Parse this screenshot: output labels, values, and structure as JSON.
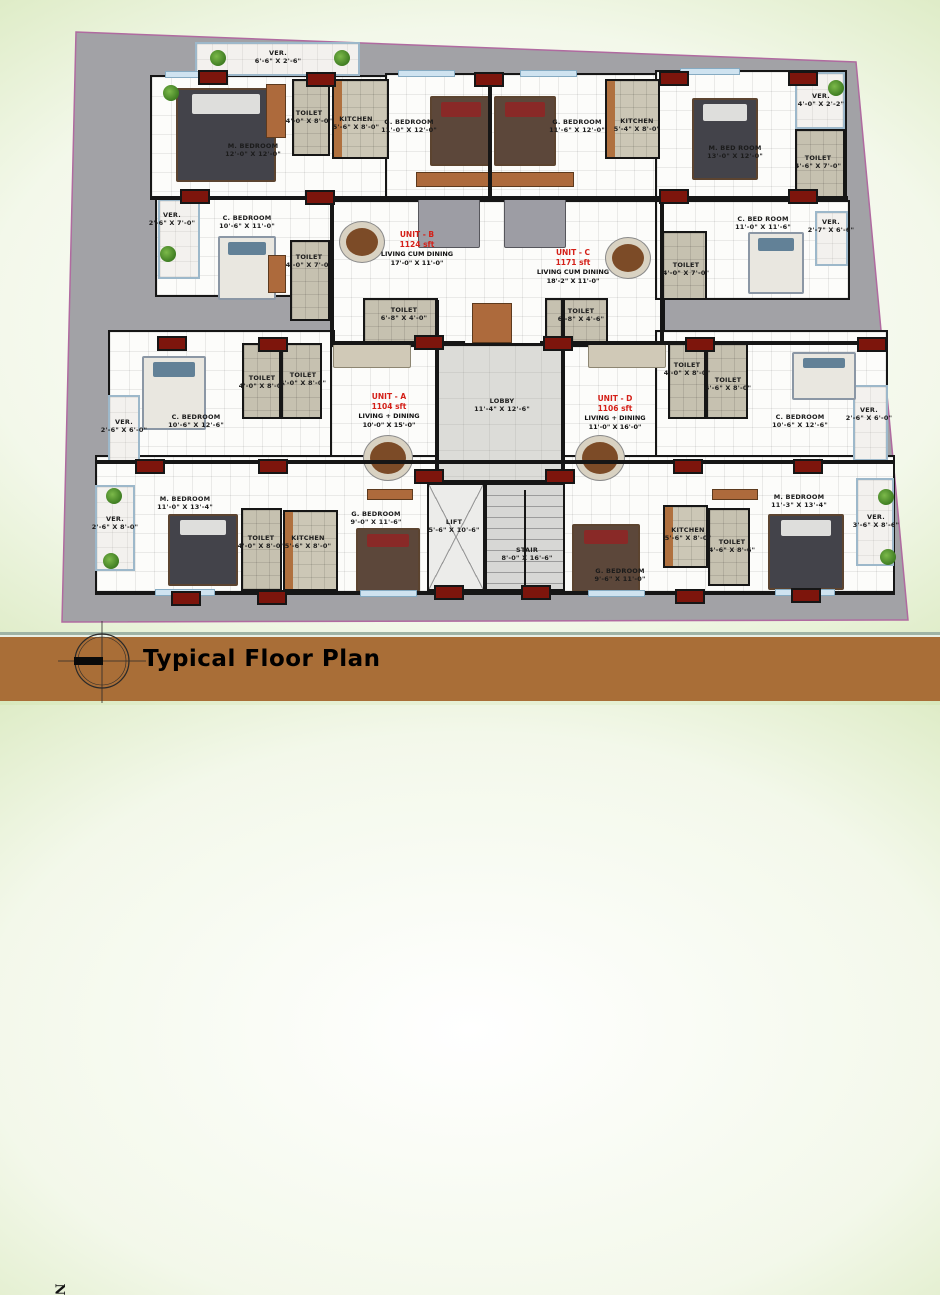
{
  "title": "Typical Floor Plan",
  "compass": {
    "north_label": "N"
  },
  "colors": {
    "background_green": "#8abc55",
    "plot_gray": "#a2a2a6",
    "plot_edge": "#b06aa0",
    "wall_black": "#161616",
    "column_red": "#7d150c",
    "unit_label_red": "#d42018",
    "title_bar_brown": "#a96e37",
    "veranda_rail_blue": "#9db8ca"
  },
  "plan": {
    "units": [
      {
        "name": "UNIT - A",
        "area": "1104 sft",
        "living": "LIVING + DINING",
        "living_dim": "10'-0\" X 15'-0\"",
        "x": 389,
        "y": 411
      },
      {
        "name": "UNIT - B",
        "area": "1124 sft",
        "living": "LIVING CUM DINING",
        "living_dim": "17'-0\" X 11'-0\"",
        "x": 417,
        "y": 249
      },
      {
        "name": "UNIT - C",
        "area": "1171 sft",
        "living": "LIVING CUM DINING",
        "living_dim": "18'-2\" X 11'-0\"",
        "x": 573,
        "y": 267
      },
      {
        "name": "UNIT - D",
        "area": "1106 sft",
        "living": "LIVING + DINING",
        "living_dim": "11'-0\" X 16'-0\"",
        "x": 615,
        "y": 413
      }
    ],
    "rooms": [
      {
        "label": "VER.",
        "dim": "6'-6\" X 2'-6\"",
        "x": 278,
        "y": 57
      },
      {
        "label": "M. BEDROOM",
        "dim": "12'-0\" X 12'-0\"",
        "x": 253,
        "y": 150
      },
      {
        "label": "TOILET",
        "dim": "4'-0\" X 8'-0\"",
        "x": 309,
        "y": 117
      },
      {
        "label": "KITCHEN",
        "dim": "5'-6\" X 8'-0\"",
        "x": 356,
        "y": 123
      },
      {
        "label": "G. BEDROOM",
        "dim": "11'-0\" X 12'-0\"",
        "x": 409,
        "y": 126
      },
      {
        "label": "G. BEDROOM",
        "dim": "11'-6\" X 12'-0\"",
        "x": 577,
        "y": 126
      },
      {
        "label": "KITCHEN",
        "dim": "5'-4\" X 8'-0\"",
        "x": 637,
        "y": 125
      },
      {
        "label": "M. BED ROOM",
        "dim": "13'-0\" X 12'-0\"",
        "x": 735,
        "y": 152
      },
      {
        "label": "VER.",
        "dim": "4'-0\" X 2'-2\"",
        "x": 821,
        "y": 100
      },
      {
        "label": "TOILET",
        "dim": "4'-6\" X 7'-0\"",
        "x": 818,
        "y": 162
      },
      {
        "label": "VER.",
        "dim": "2'-6\" X 7'-0\"",
        "x": 172,
        "y": 219
      },
      {
        "label": "C. BEDROOM",
        "dim": "10'-6\" X 11'-0\"",
        "x": 247,
        "y": 222
      },
      {
        "label": "TOILET",
        "dim": "4'-0\" X 7'-0\"",
        "x": 309,
        "y": 261
      },
      {
        "label": "C. BED ROOM",
        "dim": "11'-0\" X 11'-6\"",
        "x": 763,
        "y": 223
      },
      {
        "label": "TOILET",
        "dim": "4'-0\" X 7'-0\"",
        "x": 686,
        "y": 269
      },
      {
        "label": "VER.",
        "dim": "2'-7\" X 6'-6\"",
        "x": 831,
        "y": 226
      },
      {
        "label": "TOILET",
        "dim": "6'-8\" X 4'-0\"",
        "x": 404,
        "y": 314
      },
      {
        "label": "TOILET",
        "dim": "6'-8\" X 4'-6\"",
        "x": 581,
        "y": 315
      },
      {
        "label": "LOBBY",
        "dim": "11'-4\" X 12'-6\"",
        "x": 502,
        "y": 405
      },
      {
        "label": "C. BEDROOM",
        "dim": "10'-6\" X 12'-6\"",
        "x": 196,
        "y": 421
      },
      {
        "label": "VER.",
        "dim": "2'-6\" X 6'-0\"",
        "x": 124,
        "y": 426
      },
      {
        "label": "TOILET",
        "dim": "4'-0\" X 8'-0\"",
        "x": 262,
        "y": 382
      },
      {
        "label": "TOILET",
        "dim": "4'-0\" X 8'-0\"",
        "x": 303,
        "y": 379
      },
      {
        "label": "TOILET",
        "dim": "4'-0\" X 8'-0\"",
        "x": 687,
        "y": 369
      },
      {
        "label": "TOILET",
        "dim": "4'-6\" X 8'-0\"",
        "x": 728,
        "y": 384
      },
      {
        "label": "C. BEDROOM",
        "dim": "10'-6\" X 12'-6\"",
        "x": 800,
        "y": 421
      },
      {
        "label": "VER.",
        "dim": "2'-6\" X 6'-0\"",
        "x": 869,
        "y": 414
      },
      {
        "label": "M. BEDROOM",
        "dim": "11'-0\" X 13'-4\"",
        "x": 185,
        "y": 503
      },
      {
        "label": "VER.",
        "dim": "2'-6\" X 8'-0\"",
        "x": 115,
        "y": 523
      },
      {
        "label": "TOILET",
        "dim": "4'-0\" X 8'-0\"",
        "x": 261,
        "y": 542
      },
      {
        "label": "KITCHEN",
        "dim": "5'-6\" X 8'-0\"",
        "x": 308,
        "y": 542
      },
      {
        "label": "G. BEDROOM",
        "dim": "9'-0\" X 11'-6\"",
        "x": 376,
        "y": 518
      },
      {
        "label": "LIFT",
        "dim": "5'-6\" X 10'-6\"",
        "x": 454,
        "y": 526
      },
      {
        "label": "STAIR",
        "dim": "8'-0\" X 16'-6\"",
        "x": 527,
        "y": 554
      },
      {
        "label": "G. BEDROOM",
        "dim": "9'-6\" X 11'-0\"",
        "x": 620,
        "y": 575
      },
      {
        "label": "KITCHEN",
        "dim": "5'-6\" X 8'-0\"",
        "x": 688,
        "y": 534
      },
      {
        "label": "TOILET",
        "dim": "4'-6\" X 8'-6\"",
        "x": 732,
        "y": 546
      },
      {
        "label": "M. BEDROOM",
        "dim": "11'-3\" X 13'-4\"",
        "x": 799,
        "y": 501
      },
      {
        "label": "VER.",
        "dim": "3'-6\" X 8'-6\"",
        "x": 876,
        "y": 521
      }
    ],
    "masses": [
      {
        "x": 150,
        "y": 75,
        "w": 243,
        "h": 124
      },
      {
        "x": 385,
        "y": 73,
        "w": 278,
        "h": 132
      },
      {
        "x": 655,
        "y": 70,
        "w": 192,
        "h": 132
      },
      {
        "x": 155,
        "y": 197,
        "w": 178,
        "h": 100
      },
      {
        "x": 330,
        "y": 200,
        "w": 335,
        "h": 145
      },
      {
        "x": 655,
        "y": 200,
        "w": 195,
        "h": 100
      },
      {
        "x": 108,
        "y": 330,
        "w": 227,
        "h": 134
      },
      {
        "x": 330,
        "y": 345,
        "w": 335,
        "h": 137
      },
      {
        "x": 655,
        "y": 330,
        "w": 233,
        "h": 134
      },
      {
        "x": 95,
        "y": 455,
        "w": 800,
        "h": 140
      }
    ],
    "zones": [
      {
        "t": "ver",
        "x": 195,
        "y": 42,
        "w": 165,
        "h": 34
      },
      {
        "t": "toilet",
        "x": 292,
        "y": 79,
        "w": 38,
        "h": 77
      },
      {
        "t": "kitchen",
        "x": 332,
        "y": 79,
        "w": 57,
        "h": 80
      },
      {
        "t": "kitchen",
        "x": 605,
        "y": 79,
        "w": 55,
        "h": 80
      },
      {
        "t": "ver",
        "x": 795,
        "y": 72,
        "w": 50,
        "h": 57
      },
      {
        "t": "toilet",
        "x": 795,
        "y": 129,
        "w": 50,
        "h": 69
      },
      {
        "t": "ver",
        "x": 158,
        "y": 199,
        "w": 42,
        "h": 80
      },
      {
        "t": "toilet",
        "x": 290,
        "y": 240,
        "w": 40,
        "h": 81
      },
      {
        "t": "toilet",
        "x": 662,
        "y": 231,
        "w": 45,
        "h": 69
      },
      {
        "t": "ver",
        "x": 815,
        "y": 211,
        "w": 33,
        "h": 55
      },
      {
        "t": "toilet",
        "x": 363,
        "y": 298,
        "w": 75,
        "h": 46
      },
      {
        "t": "toilet",
        "x": 545,
        "y": 298,
        "w": 63,
        "h": 46
      },
      {
        "t": "lobby",
        "x": 437,
        "y": 346,
        "w": 126,
        "h": 136
      },
      {
        "t": "ver",
        "x": 108,
        "y": 395,
        "w": 32,
        "h": 67
      },
      {
        "t": "toilet",
        "x": 242,
        "y": 343,
        "w": 39,
        "h": 76
      },
      {
        "t": "toilet",
        "x": 281,
        "y": 343,
        "w": 41,
        "h": 76
      },
      {
        "t": "toilet",
        "x": 668,
        "y": 343,
        "w": 38,
        "h": 76
      },
      {
        "t": "toilet",
        "x": 706,
        "y": 343,
        "w": 42,
        "h": 76
      },
      {
        "t": "ver",
        "x": 853,
        "y": 385,
        "w": 35,
        "h": 76
      },
      {
        "t": "ver",
        "x": 95,
        "y": 485,
        "w": 40,
        "h": 86
      },
      {
        "t": "toilet",
        "x": 241,
        "y": 508,
        "w": 41,
        "h": 83
      },
      {
        "t": "kitchen",
        "x": 283,
        "y": 510,
        "w": 55,
        "h": 81
      },
      {
        "t": "lift",
        "x": 427,
        "y": 483,
        "w": 58,
        "h": 108
      },
      {
        "t": "stair",
        "x": 485,
        "y": 483,
        "w": 80,
        "h": 108
      },
      {
        "t": "kitchen",
        "x": 663,
        "y": 505,
        "w": 45,
        "h": 63
      },
      {
        "t": "toilet",
        "x": 708,
        "y": 508,
        "w": 42,
        "h": 78
      },
      {
        "t": "ver",
        "x": 856,
        "y": 478,
        "w": 38,
        "h": 88
      }
    ],
    "walls": [
      {
        "x": 488,
        "y": 75,
        "w": 4,
        "h": 125
      },
      {
        "x": 150,
        "y": 196,
        "w": 698,
        "h": 4
      },
      {
        "x": 330,
        "y": 341,
        "w": 135,
        "h": 4
      },
      {
        "x": 540,
        "y": 341,
        "w": 348,
        "h": 4
      },
      {
        "x": 95,
        "y": 460,
        "w": 800,
        "h": 4
      },
      {
        "x": 95,
        "y": 591,
        "w": 798,
        "h": 4
      },
      {
        "x": 435,
        "y": 300,
        "w": 4,
        "h": 184
      },
      {
        "x": 561,
        "y": 300,
        "w": 4,
        "h": 184
      },
      {
        "x": 425,
        "y": 480,
        "w": 142,
        "h": 4
      },
      {
        "x": 483,
        "y": 483,
        "w": 4,
        "h": 108
      },
      {
        "x": 524,
        "y": 490,
        "w": 2,
        "h": 95
      },
      {
        "x": 330,
        "y": 200,
        "w": 4,
        "h": 145
      },
      {
        "x": 660,
        "y": 200,
        "w": 4,
        "h": 145
      }
    ],
    "columns": [
      {
        "x": 213,
        "y": 77
      },
      {
        "x": 321,
        "y": 79
      },
      {
        "x": 489,
        "y": 79
      },
      {
        "x": 674,
        "y": 78
      },
      {
        "x": 803,
        "y": 78
      },
      {
        "x": 195,
        "y": 196
      },
      {
        "x": 320,
        "y": 197
      },
      {
        "x": 674,
        "y": 196
      },
      {
        "x": 803,
        "y": 196
      },
      {
        "x": 172,
        "y": 343
      },
      {
        "x": 273,
        "y": 344
      },
      {
        "x": 429,
        "y": 342
      },
      {
        "x": 558,
        "y": 343
      },
      {
        "x": 700,
        "y": 344
      },
      {
        "x": 872,
        "y": 344
      },
      {
        "x": 150,
        "y": 466
      },
      {
        "x": 273,
        "y": 466
      },
      {
        "x": 429,
        "y": 476
      },
      {
        "x": 560,
        "y": 476
      },
      {
        "x": 688,
        "y": 466
      },
      {
        "x": 808,
        "y": 466
      },
      {
        "x": 186,
        "y": 598
      },
      {
        "x": 272,
        "y": 597
      },
      {
        "x": 449,
        "y": 592
      },
      {
        "x": 536,
        "y": 592
      },
      {
        "x": 690,
        "y": 596
      },
      {
        "x": 806,
        "y": 595
      }
    ],
    "windows": [
      {
        "x": 165,
        "y": 71,
        "w": 58
      },
      {
        "x": 398,
        "y": 70,
        "w": 55
      },
      {
        "x": 520,
        "y": 70,
        "w": 55
      },
      {
        "x": 680,
        "y": 68,
        "w": 58
      },
      {
        "x": 155,
        "y": 589,
        "w": 58
      },
      {
        "x": 360,
        "y": 590,
        "w": 55
      },
      {
        "x": 588,
        "y": 590,
        "w": 55
      },
      {
        "x": 775,
        "y": 589,
        "w": 58
      }
    ],
    "furniture": [
      {
        "t": "bed dark",
        "x": 176,
        "y": 88,
        "w": 96,
        "h": 90
      },
      {
        "t": "bed brown",
        "x": 430,
        "y": 96,
        "w": 58,
        "h": 66
      },
      {
        "t": "bed brown",
        "x": 494,
        "y": 96,
        "w": 58,
        "h": 66
      },
      {
        "t": "bed dark",
        "x": 692,
        "y": 98,
        "w": 62,
        "h": 78
      },
      {
        "t": "bed light",
        "x": 218,
        "y": 236,
        "w": 54,
        "h": 60
      },
      {
        "t": "bed light",
        "x": 748,
        "y": 232,
        "w": 52,
        "h": 58
      },
      {
        "t": "bed light",
        "x": 142,
        "y": 356,
        "w": 60,
        "h": 70
      },
      {
        "t": "bed light",
        "x": 792,
        "y": 352,
        "w": 60,
        "h": 44
      },
      {
        "t": "bed dark",
        "x": 168,
        "y": 514,
        "w": 66,
        "h": 68
      },
      {
        "t": "bed brown",
        "x": 356,
        "y": 528,
        "w": 60,
        "h": 60
      },
      {
        "t": "bed brown",
        "x": 572,
        "y": 524,
        "w": 64,
        "h": 64
      },
      {
        "t": "bed dark",
        "x": 768,
        "y": 514,
        "w": 72,
        "h": 72
      },
      {
        "t": "sofa",
        "x": 418,
        "y": 196,
        "w": 60,
        "h": 50
      },
      {
        "t": "sofa",
        "x": 504,
        "y": 196,
        "w": 60,
        "h": 50
      },
      {
        "t": "sofa beige",
        "x": 333,
        "y": 344,
        "w": 76,
        "h": 22
      },
      {
        "t": "sofa beige",
        "x": 588,
        "y": 344,
        "w": 76,
        "h": 22
      },
      {
        "t": "wood",
        "x": 416,
        "y": 172,
        "w": 158,
        "h": 15
      },
      {
        "t": "wood",
        "x": 266,
        "y": 84,
        "w": 20,
        "h": 54
      },
      {
        "t": "wood",
        "x": 268,
        "y": 255,
        "w": 18,
        "h": 38
      },
      {
        "t": "wood",
        "x": 472,
        "y": 303,
        "w": 40,
        "h": 40
      },
      {
        "t": "wood",
        "x": 367,
        "y": 489,
        "w": 46,
        "h": 11
      },
      {
        "t": "wood",
        "x": 712,
        "y": 489,
        "w": 46,
        "h": 11
      },
      {
        "t": "dining",
        "x": 340,
        "y": 222,
        "w": 44,
        "h": 40
      },
      {
        "t": "dining",
        "x": 606,
        "y": 238,
        "w": 44,
        "h": 40
      },
      {
        "t": "dining",
        "x": 364,
        "y": 436,
        "w": 48,
        "h": 44
      },
      {
        "t": "dining",
        "x": 576,
        "y": 436,
        "w": 48,
        "h": 44
      }
    ],
    "plants": [
      {
        "x": 163,
        "y": 85
      },
      {
        "x": 210,
        "y": 50
      },
      {
        "x": 334,
        "y": 50
      },
      {
        "x": 828,
        "y": 80
      },
      {
        "x": 160,
        "y": 246
      },
      {
        "x": 106,
        "y": 488
      },
      {
        "x": 103,
        "y": 553
      },
      {
        "x": 878,
        "y": 489
      },
      {
        "x": 880,
        "y": 549
      }
    ]
  }
}
